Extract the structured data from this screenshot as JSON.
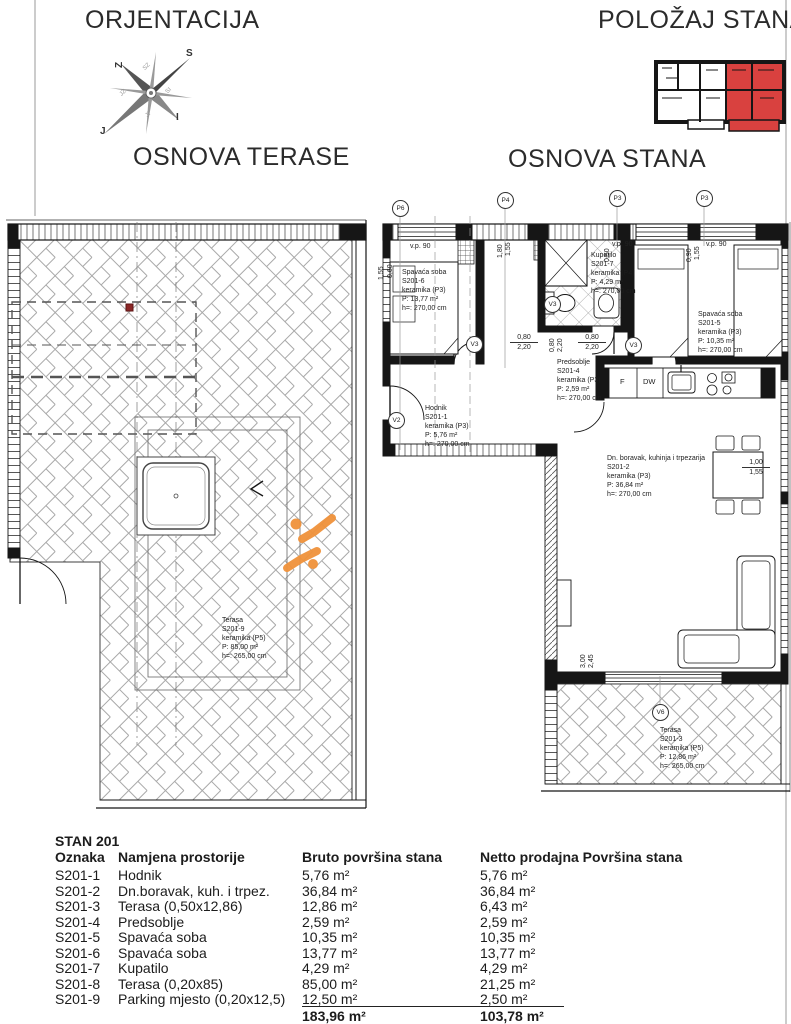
{
  "header": {
    "orientation_title": "ORJENTACIJA",
    "position_title": "POLOŽAJ STANA",
    "terrace_title": "OSNOVA TERASE",
    "apartment_title": "OSNOVA STANA"
  },
  "compass": {
    "ne": "S",
    "nw": "Z",
    "se": "I",
    "sw": "J",
    "top": "SZ",
    "left": "JZ",
    "bottom": "JI",
    "right": "SI"
  },
  "colors": {
    "highlight_red": "#d9413f",
    "logo_orange": "#f0923b",
    "line_dark": "#161616"
  },
  "rooms": [
    {
      "name": "Spavaća soba",
      "id": "S201-6",
      "finish": "keramika (P3)",
      "area": "P: 13,77 m²",
      "height": "h=: 270,00 cm"
    },
    {
      "name": "Kupatilo",
      "id": "S201-7",
      "finish": "keramika (P4)",
      "area": "P: 4,29 m²",
      "height": "h=: 270,00 cm"
    },
    {
      "name": "Spavaća soba",
      "id": "S201-5",
      "finish": "keramika (P3)",
      "area": "P: 10,35 m²",
      "height": "h=: 270,00 cm"
    },
    {
      "name": "Predsoblje",
      "id": "S201-4",
      "finish": "keramika (P3)",
      "area": "P: 2,59 m²",
      "height": "h=: 270,00 cm"
    },
    {
      "name": "Hodnik",
      "id": "S201-1",
      "finish": "keramika (P3)",
      "area": "P: 5,76 m²",
      "height": "h=: 270,00 cm"
    },
    {
      "name": "Dn. boravak, kuhinja i trpezarija",
      "id": "S201-2",
      "finish": "keramika (P3)",
      "area": "P: 36,84 m²",
      "height": "h=: 270,00 cm"
    },
    {
      "name": "Terasa",
      "id": "S201-3",
      "finish": "keramika (P5)",
      "area": "P: 12,86 m²",
      "height": "h=: 265,00 cm"
    },
    {
      "name": "Terasa",
      "id": "S201-9",
      "finish": "keramika (P5)",
      "area": "P: 85,00 m²",
      "height": "h=: 265,00 cm"
    }
  ],
  "markers": {
    "p6": "P6",
    "p4": "P4",
    "p3": "P3",
    "v2": "V2",
    "v3": "V3",
    "v6": "V6"
  },
  "kitchen": {
    "fridge": "F",
    "dishwasher": "DW"
  },
  "dims": {
    "vp": "v.p. 90",
    "d060": "0,60",
    "d155": "1,55",
    "d180": "1,80",
    "d090": "0,90",
    "d080": "0,80",
    "d220": "2,20",
    "d050": "0,50",
    "d100": "1,00",
    "d300": "3,00",
    "d245": "2,45"
  },
  "table": {
    "title": "STAN 201",
    "columns": [
      "Oznaka",
      "Namjena prostorije",
      "Bruto površina stana",
      "Netto prodajna Površina stana"
    ],
    "rows": [
      {
        "id": "S201-1",
        "name": "Hodnik",
        "bruto": "5,76 m²",
        "netto": "5,76 m²"
      },
      {
        "id": "S201-2",
        "name": "Dn.boravak, kuh. i trpez.",
        "bruto": "36,84 m²",
        "netto": "36,84 m²"
      },
      {
        "id": "S201-3",
        "name": "Terasa (0,50x12,86)",
        "bruto": "12,86 m²",
        "netto": "6,43 m²"
      },
      {
        "id": "S201-4",
        "name": "Predsoblje",
        "bruto": "2,59 m²",
        "netto": "2,59 m²"
      },
      {
        "id": "S201-5",
        "name": "Spavaća soba",
        "bruto": "10,35 m²",
        "netto": "10,35 m²"
      },
      {
        "id": "S201-6",
        "name": "Spavaća soba",
        "bruto": "13,77 m²",
        "netto": "13,77 m²"
      },
      {
        "id": "S201-7",
        "name": "Kupatilo",
        "bruto": "4,29 m²",
        "netto": "4,29 m²"
      },
      {
        "id": "S201-8",
        "name": "Terasa (0,20x85)",
        "bruto": "85,00 m²",
        "netto": "21,25 m²"
      },
      {
        "id": "S201-9",
        "name": "Parking mjesto (0,20x12,5)",
        "bruto": "12,50 m²",
        "netto": "2,50 m²"
      }
    ],
    "total_bruto": "183,96 m²",
    "total_netto": "103,78 m²"
  }
}
